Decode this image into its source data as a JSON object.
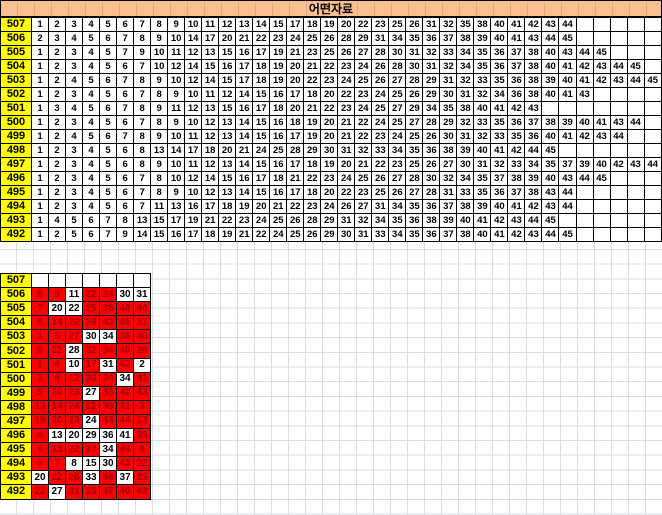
{
  "title": "어떤자료",
  "colors": {
    "header_fill": "#FAC08F",
    "label_fill": "#FFFF00",
    "highlight_fill": "#FF0000",
    "highlight_text": "#9C0006",
    "cell_border": "#000000",
    "gridline": "#D6DCE6"
  },
  "top_table": {
    "columns": 37,
    "rows": [
      {
        "label": "507",
        "values": [
          1,
          2,
          3,
          4,
          5,
          6,
          7,
          8,
          9,
          10,
          11,
          12,
          13,
          14,
          15,
          17,
          18,
          19,
          20,
          22,
          23,
          25,
          26,
          31,
          32,
          35,
          38,
          40,
          41,
          42,
          43,
          44
        ]
      },
      {
        "label": "506",
        "values": [
          2,
          3,
          4,
          5,
          6,
          7,
          8,
          9,
          10,
          14,
          17,
          20,
          21,
          22,
          23,
          24,
          25,
          26,
          28,
          29,
          31,
          34,
          35,
          36,
          37,
          38,
          39,
          40,
          41,
          43,
          44,
          45
        ]
      },
      {
        "label": "505",
        "values": [
          1,
          2,
          3,
          4,
          5,
          7,
          9,
          10,
          11,
          12,
          13,
          15,
          16,
          17,
          19,
          21,
          23,
          25,
          26,
          27,
          28,
          30,
          31,
          32,
          33,
          34,
          35,
          36,
          37,
          38,
          40,
          43,
          44,
          45
        ]
      },
      {
        "label": "504",
        "values": [
          1,
          2,
          3,
          4,
          5,
          6,
          7,
          10,
          12,
          14,
          15,
          16,
          17,
          18,
          19,
          20,
          21,
          22,
          23,
          24,
          26,
          28,
          30,
          31,
          32,
          34,
          35,
          36,
          37,
          38,
          40,
          41,
          42,
          43,
          44,
          45
        ]
      },
      {
        "label": "503",
        "values": [
          1,
          2,
          4,
          5,
          6,
          7,
          8,
          9,
          10,
          12,
          14,
          15,
          17,
          18,
          19,
          20,
          22,
          23,
          24,
          25,
          26,
          27,
          28,
          29,
          31,
          32,
          33,
          35,
          36,
          38,
          39,
          40,
          41,
          42,
          43,
          44,
          45
        ]
      },
      {
        "label": "502",
        "values": [
          1,
          2,
          3,
          4,
          5,
          6,
          7,
          8,
          9,
          10,
          11,
          12,
          14,
          15,
          16,
          17,
          18,
          20,
          22,
          23,
          24,
          25,
          26,
          29,
          30,
          31,
          32,
          34,
          36,
          38,
          40,
          41,
          43
        ]
      },
      {
        "label": "501",
        "values": [
          1,
          3,
          4,
          5,
          6,
          7,
          8,
          9,
          11,
          12,
          13,
          15,
          16,
          17,
          18,
          20,
          21,
          22,
          23,
          24,
          25,
          27,
          29,
          34,
          35,
          38,
          40,
          41,
          42,
          43
        ]
      },
      {
        "label": "500",
        "values": [
          1,
          2,
          3,
          4,
          5,
          6,
          7,
          8,
          9,
          10,
          12,
          13,
          14,
          15,
          16,
          18,
          19,
          20,
          21,
          22,
          24,
          25,
          27,
          28,
          29,
          32,
          33,
          35,
          36,
          37,
          38,
          39,
          40,
          41,
          43,
          44
        ]
      },
      {
        "label": "499",
        "values": [
          1,
          2,
          4,
          5,
          6,
          7,
          8,
          9,
          10,
          11,
          12,
          13,
          14,
          15,
          16,
          17,
          19,
          20,
          21,
          22,
          23,
          24,
          25,
          26,
          30,
          31,
          32,
          33,
          35,
          36,
          40,
          41,
          42,
          43,
          44
        ]
      },
      {
        "label": "498",
        "values": [
          1,
          2,
          3,
          4,
          5,
          6,
          8,
          13,
          14,
          17,
          18,
          20,
          21,
          24,
          25,
          28,
          29,
          30,
          31,
          32,
          33,
          34,
          35,
          36,
          38,
          39,
          40,
          41,
          42,
          44,
          45
        ]
      },
      {
        "label": "497",
        "values": [
          1,
          2,
          3,
          4,
          5,
          6,
          8,
          9,
          10,
          11,
          12,
          13,
          14,
          15,
          16,
          17,
          18,
          19,
          20,
          21,
          22,
          23,
          25,
          26,
          27,
          30,
          31,
          32,
          33,
          34,
          35,
          37,
          39,
          40,
          42,
          43,
          44
        ]
      },
      {
        "label": "496",
        "values": [
          1,
          2,
          3,
          4,
          5,
          6,
          7,
          8,
          10,
          12,
          14,
          15,
          16,
          17,
          18,
          21,
          22,
          23,
          24,
          25,
          26,
          27,
          28,
          30,
          32,
          34,
          35,
          37,
          38,
          39,
          40,
          43,
          44,
          45
        ]
      },
      {
        "label": "495",
        "values": [
          1,
          2,
          3,
          4,
          5,
          6,
          7,
          8,
          9,
          10,
          12,
          13,
          14,
          15,
          16,
          17,
          18,
          20,
          22,
          23,
          25,
          26,
          27,
          28,
          31,
          33,
          35,
          36,
          37,
          38,
          43,
          44
        ]
      },
      {
        "label": "494",
        "values": [
          1,
          2,
          3,
          4,
          5,
          6,
          7,
          11,
          13,
          16,
          17,
          18,
          19,
          20,
          21,
          22,
          23,
          24,
          26,
          27,
          31,
          34,
          35,
          36,
          37,
          38,
          39,
          40,
          41,
          42,
          43,
          44
        ]
      },
      {
        "label": "493",
        "values": [
          1,
          4,
          5,
          6,
          7,
          8,
          13,
          15,
          17,
          19,
          21,
          22,
          23,
          24,
          25,
          26,
          28,
          29,
          31,
          32,
          34,
          35,
          36,
          38,
          39,
          40,
          41,
          42,
          43,
          44,
          45
        ]
      },
      {
        "label": "492",
        "values": [
          1,
          2,
          5,
          6,
          7,
          9,
          14,
          15,
          16,
          17,
          18,
          19,
          21,
          22,
          24,
          25,
          26,
          29,
          30,
          31,
          33,
          34,
          35,
          36,
          37,
          38,
          40,
          41,
          42,
          43,
          44,
          45
        ]
      }
    ]
  },
  "bottom_table": {
    "columns": 7,
    "rows": [
      {
        "label": "507",
        "cells": []
      },
      {
        "label": "506",
        "cells": [
          [
            6,
            1
          ],
          [
            9,
            1
          ],
          [
            11,
            0
          ],
          [
            22,
            1
          ],
          [
            24,
            1
          ],
          [
            30,
            0
          ],
          [
            31,
            0
          ]
        ]
      },
      {
        "label": "505",
        "cells": [
          [
            7,
            1
          ],
          [
            20,
            0
          ],
          [
            22,
            0
          ],
          [
            25,
            1
          ],
          [
            38,
            1
          ],
          [
            40,
            1
          ],
          [
            44,
            1
          ]
        ]
      },
      {
        "label": "504",
        "cells": [
          [
            6,
            1
          ],
          [
            14,
            1
          ],
          [
            22,
            1
          ],
          [
            26,
            1
          ],
          [
            43,
            1
          ],
          [
            45,
            1
          ],
          [
            31,
            1
          ]
        ]
      },
      {
        "label": "503",
        "cells": [
          [
            1,
            1
          ],
          [
            5,
            1
          ],
          [
            27,
            1
          ],
          [
            30,
            0
          ],
          [
            34,
            0
          ],
          [
            36,
            1
          ],
          [
            40,
            1
          ]
        ]
      },
      {
        "label": "502",
        "cells": [
          [
            6,
            1
          ],
          [
            22,
            1
          ],
          [
            28,
            0
          ],
          [
            32,
            1
          ],
          [
            34,
            1
          ],
          [
            40,
            1
          ],
          [
            26,
            1
          ]
        ]
      },
      {
        "label": "501",
        "cells": [
          [
            1,
            1
          ],
          [
            4,
            1
          ],
          [
            10,
            0
          ],
          [
            17,
            1
          ],
          [
            31,
            0
          ],
          [
            42,
            1
          ],
          [
            2,
            0
          ]
        ]
      },
      {
        "label": "500",
        "cells": [
          [
            3,
            1
          ],
          [
            4,
            1
          ],
          [
            12,
            1
          ],
          [
            20,
            1
          ],
          [
            24,
            1
          ],
          [
            34,
            0
          ],
          [
            41,
            1
          ]
        ]
      },
      {
        "label": "499",
        "cells": [
          [
            5,
            1
          ],
          [
            20,
            1
          ],
          [
            23,
            1
          ],
          [
            27,
            0
          ],
          [
            35,
            1
          ],
          [
            40,
            1
          ],
          [
            43,
            1
          ]
        ]
      },
      {
        "label": "498",
        "cells": [
          [
            13,
            1
          ],
          [
            14,
            1
          ],
          [
            24,
            1
          ],
          [
            32,
            1
          ],
          [
            39,
            1
          ],
          [
            41,
            1
          ],
          [
            3,
            1
          ]
        ]
      },
      {
        "label": "497",
        "cells": [
          [
            19,
            1
          ],
          [
            20,
            1
          ],
          [
            23,
            1
          ],
          [
            24,
            0
          ],
          [
            43,
            1
          ],
          [
            44,
            1
          ],
          [
            13,
            1
          ]
        ]
      },
      {
        "label": "496",
        "cells": [
          [
            4,
            1
          ],
          [
            13,
            0
          ],
          [
            20,
            0
          ],
          [
            29,
            0
          ],
          [
            36,
            0
          ],
          [
            41,
            0
          ],
          [
            39,
            1
          ]
        ]
      },
      {
        "label": "495",
        "cells": [
          [
            4,
            1
          ],
          [
            13,
            1
          ],
          [
            22,
            1
          ],
          [
            27,
            1
          ],
          [
            34,
            0
          ],
          [
            44,
            1
          ],
          [
            6,
            1
          ]
        ]
      },
      {
        "label": "494",
        "cells": [
          [
            5,
            1
          ],
          [
            7,
            1
          ],
          [
            8,
            0
          ],
          [
            15,
            0
          ],
          [
            30,
            0
          ],
          [
            43,
            1
          ],
          [
            22,
            1
          ]
        ]
      },
      {
        "label": "493",
        "cells": [
          [
            20,
            0
          ],
          [
            22,
            1
          ],
          [
            26,
            1
          ],
          [
            33,
            0
          ],
          [
            36,
            1
          ],
          [
            37,
            0
          ],
          [
            25,
            1
          ]
        ]
      },
      {
        "label": "492",
        "cells": [
          [
            22,
            1
          ],
          [
            27,
            0
          ],
          [
            31,
            1
          ],
          [
            35,
            1
          ],
          [
            37,
            1
          ],
          [
            40,
            1
          ],
          [
            42,
            1
          ]
        ]
      }
    ]
  }
}
